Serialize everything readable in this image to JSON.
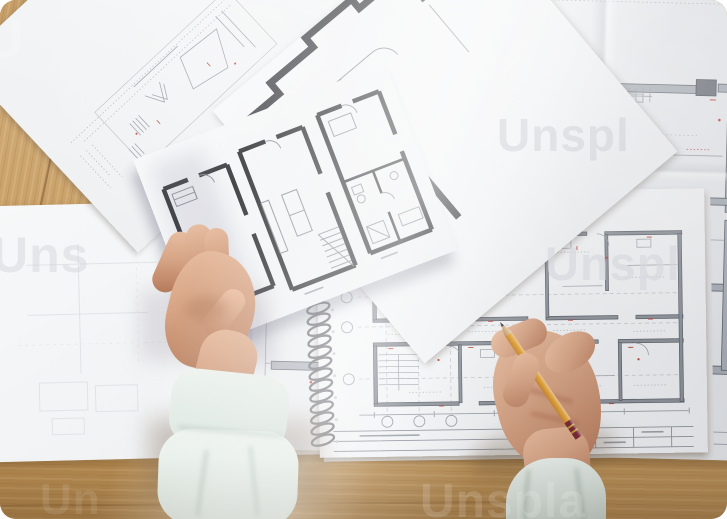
{
  "image": {
    "description": "Overhead photo of an architect's hands at a wooden desk: the left hand holds loose printed floor-plan sheets, the right hand marks a spiral-bound apartment floor plan with a yellow graphite pencil; a large unfolded blueprint with red revision marks lies underneath.",
    "width": "727",
    "height": "519"
  },
  "watermark": {
    "brand": "Unsplash",
    "fragments": [
      {
        "text": "U"
      },
      {
        "text": "Unspl"
      },
      {
        "text": "Uns"
      },
      {
        "text": "Unspl"
      },
      {
        "text": "Unspla"
      },
      {
        "text": "Un"
      }
    ]
  },
  "scene": {
    "surface": "wooden desk",
    "objects": [
      "large blueprint with red revision marks",
      "spiral-bound sketchpad with apartment floor plan",
      "three loose floor-plan sheets",
      "left hand holding a sheet",
      "right hand writing with a pencil",
      "yellow graphite pencil"
    ]
  },
  "colors": {
    "wood": "#c49a5f",
    "paper": "#f4f5f7",
    "blueprint_lines": "#8b9098",
    "bold_walls": "#3a3b3e",
    "red_markup": "#bf4335",
    "skin": "#d8a98c",
    "sleeve": "#dfe8e2",
    "pencil_body": "#e9a83e",
    "pencil_ferrule": "#7c2635",
    "spiral_wire": "#5f5f66"
  }
}
